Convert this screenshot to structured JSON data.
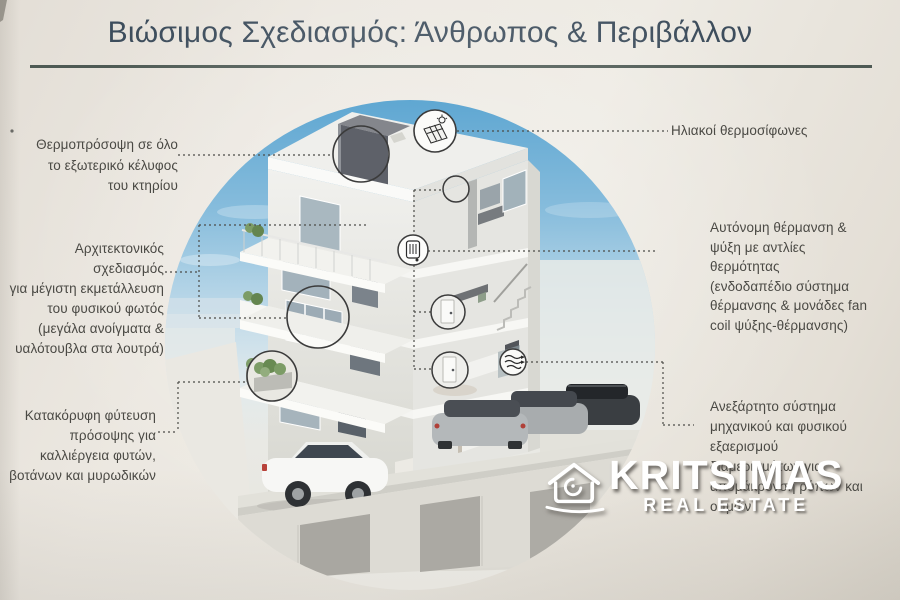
{
  "title": "Βιώσιμος Σχεδιασμός: Άνθρωπος & Περιβάλλον",
  "annotations": {
    "left": [
      {
        "label": "thermal-insulation",
        "text": "Θερμοπρόσοψη σε όλο\nτο εξωτερικό κέλυφος\nτου κτηρίου"
      },
      {
        "label": "architectural-design",
        "text": "Αρχιτεκτονικός σχεδιασμός\nγια μέγιστη εκμετάλλευση\nτου φυσικού φωτός\n(μεγάλα ανοίγματα &\nυαλότουβλα στα λουτρά)"
      },
      {
        "label": "vertical-planting",
        "text": "Κατακόρυφη φύτευση\nπρόσοψης για\nκαλλιέργεια φυτών,\nβοτάνων και μυρωδικών"
      }
    ],
    "right": [
      {
        "label": "solar-water-heaters",
        "text": "Ηλιακοί θερμοσίφωνες"
      },
      {
        "label": "autonomous-hvac",
        "text": "Αυτόνομη θέρμανση &\nψύξη με αντλίες\nθερμότητας\n(ενδοδαπέδιο σύστημα\nθέρμανσης & μονάδες fan\ncoil ψύξης-θέρμανσης)"
      },
      {
        "label": "independent-ventilation",
        "text": "Ανεξάρτητο σύστημα\nμηχανικού και φυσικού\nεξαερισμού\nδιαμερισμάτων για\nαπομάκρυνση ρύπων και\nοσμών"
      }
    ]
  },
  "watermark": {
    "brand": "KRITSIMAS",
    "tagline": "REAL ESTATE",
    "logo": "house-swirl-icon"
  },
  "illustration": {
    "description": "Circular cutaway rendering of a four-storey apartment building with balconies, planted facade and underground parking with cars",
    "icons": [
      "solar-panel-icon",
      "radiator-icon",
      "airflow-icon"
    ],
    "callouts": [
      "thermal facade wall",
      "solar panel on roof",
      "bathroom",
      "heating unit",
      "large window",
      "fan coil door upper",
      "fan coil door lower",
      "facade planter",
      "ventilation unit"
    ]
  },
  "colors": {
    "background": "#e9e5de",
    "title": "#3d4d5c",
    "rule": "#4e5a54",
    "annotation_text": "#4a4944",
    "leader_line": "#4b4b47",
    "sky": "#60a8d2",
    "watermark": "#ffffff"
  }
}
